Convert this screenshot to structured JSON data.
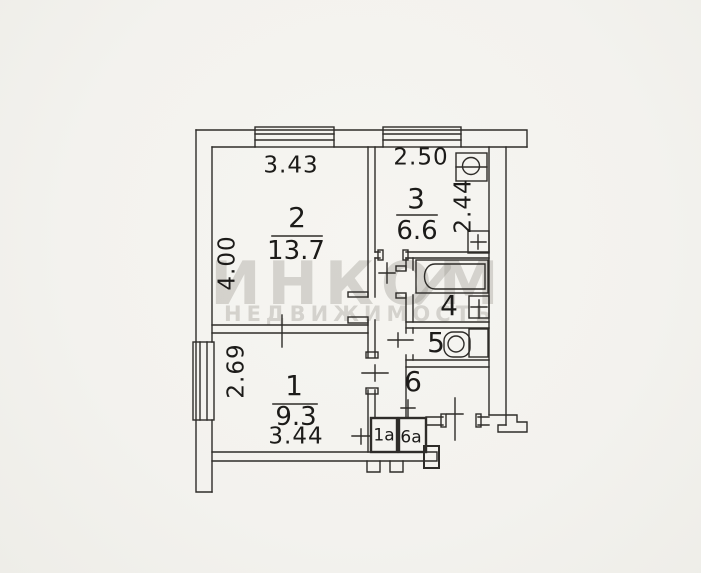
{
  "watermark": {
    "title": "ИНКОМ",
    "subtitle": "НЕДВИЖИМОСТЬ"
  },
  "rooms": {
    "r1": {
      "number": "1",
      "area": "9.3"
    },
    "r2": {
      "number": "2",
      "area": "13.7"
    },
    "r3": {
      "number": "3",
      "area": "6.6"
    },
    "r4": {
      "number": "4"
    },
    "r5": {
      "number": "5"
    },
    "r6": {
      "number": "6"
    },
    "r1a": {
      "number": "1а"
    },
    "r6a": {
      "number": "6а"
    }
  },
  "dimensions": {
    "room2_width": "3.43",
    "kitchen_width": "2.50",
    "kitchen_depth": "2.44",
    "room2_depth": "4.00",
    "room1_depth": "2.69",
    "room1_width": "3.44"
  },
  "fixtures": [
    "bathtub",
    "wash-basin",
    "kitchen-sink",
    "stove",
    "toilet"
  ],
  "colors": {
    "background": "#f4f3ee",
    "line": "#2e2c29",
    "watermark": "#cfccc5"
  }
}
